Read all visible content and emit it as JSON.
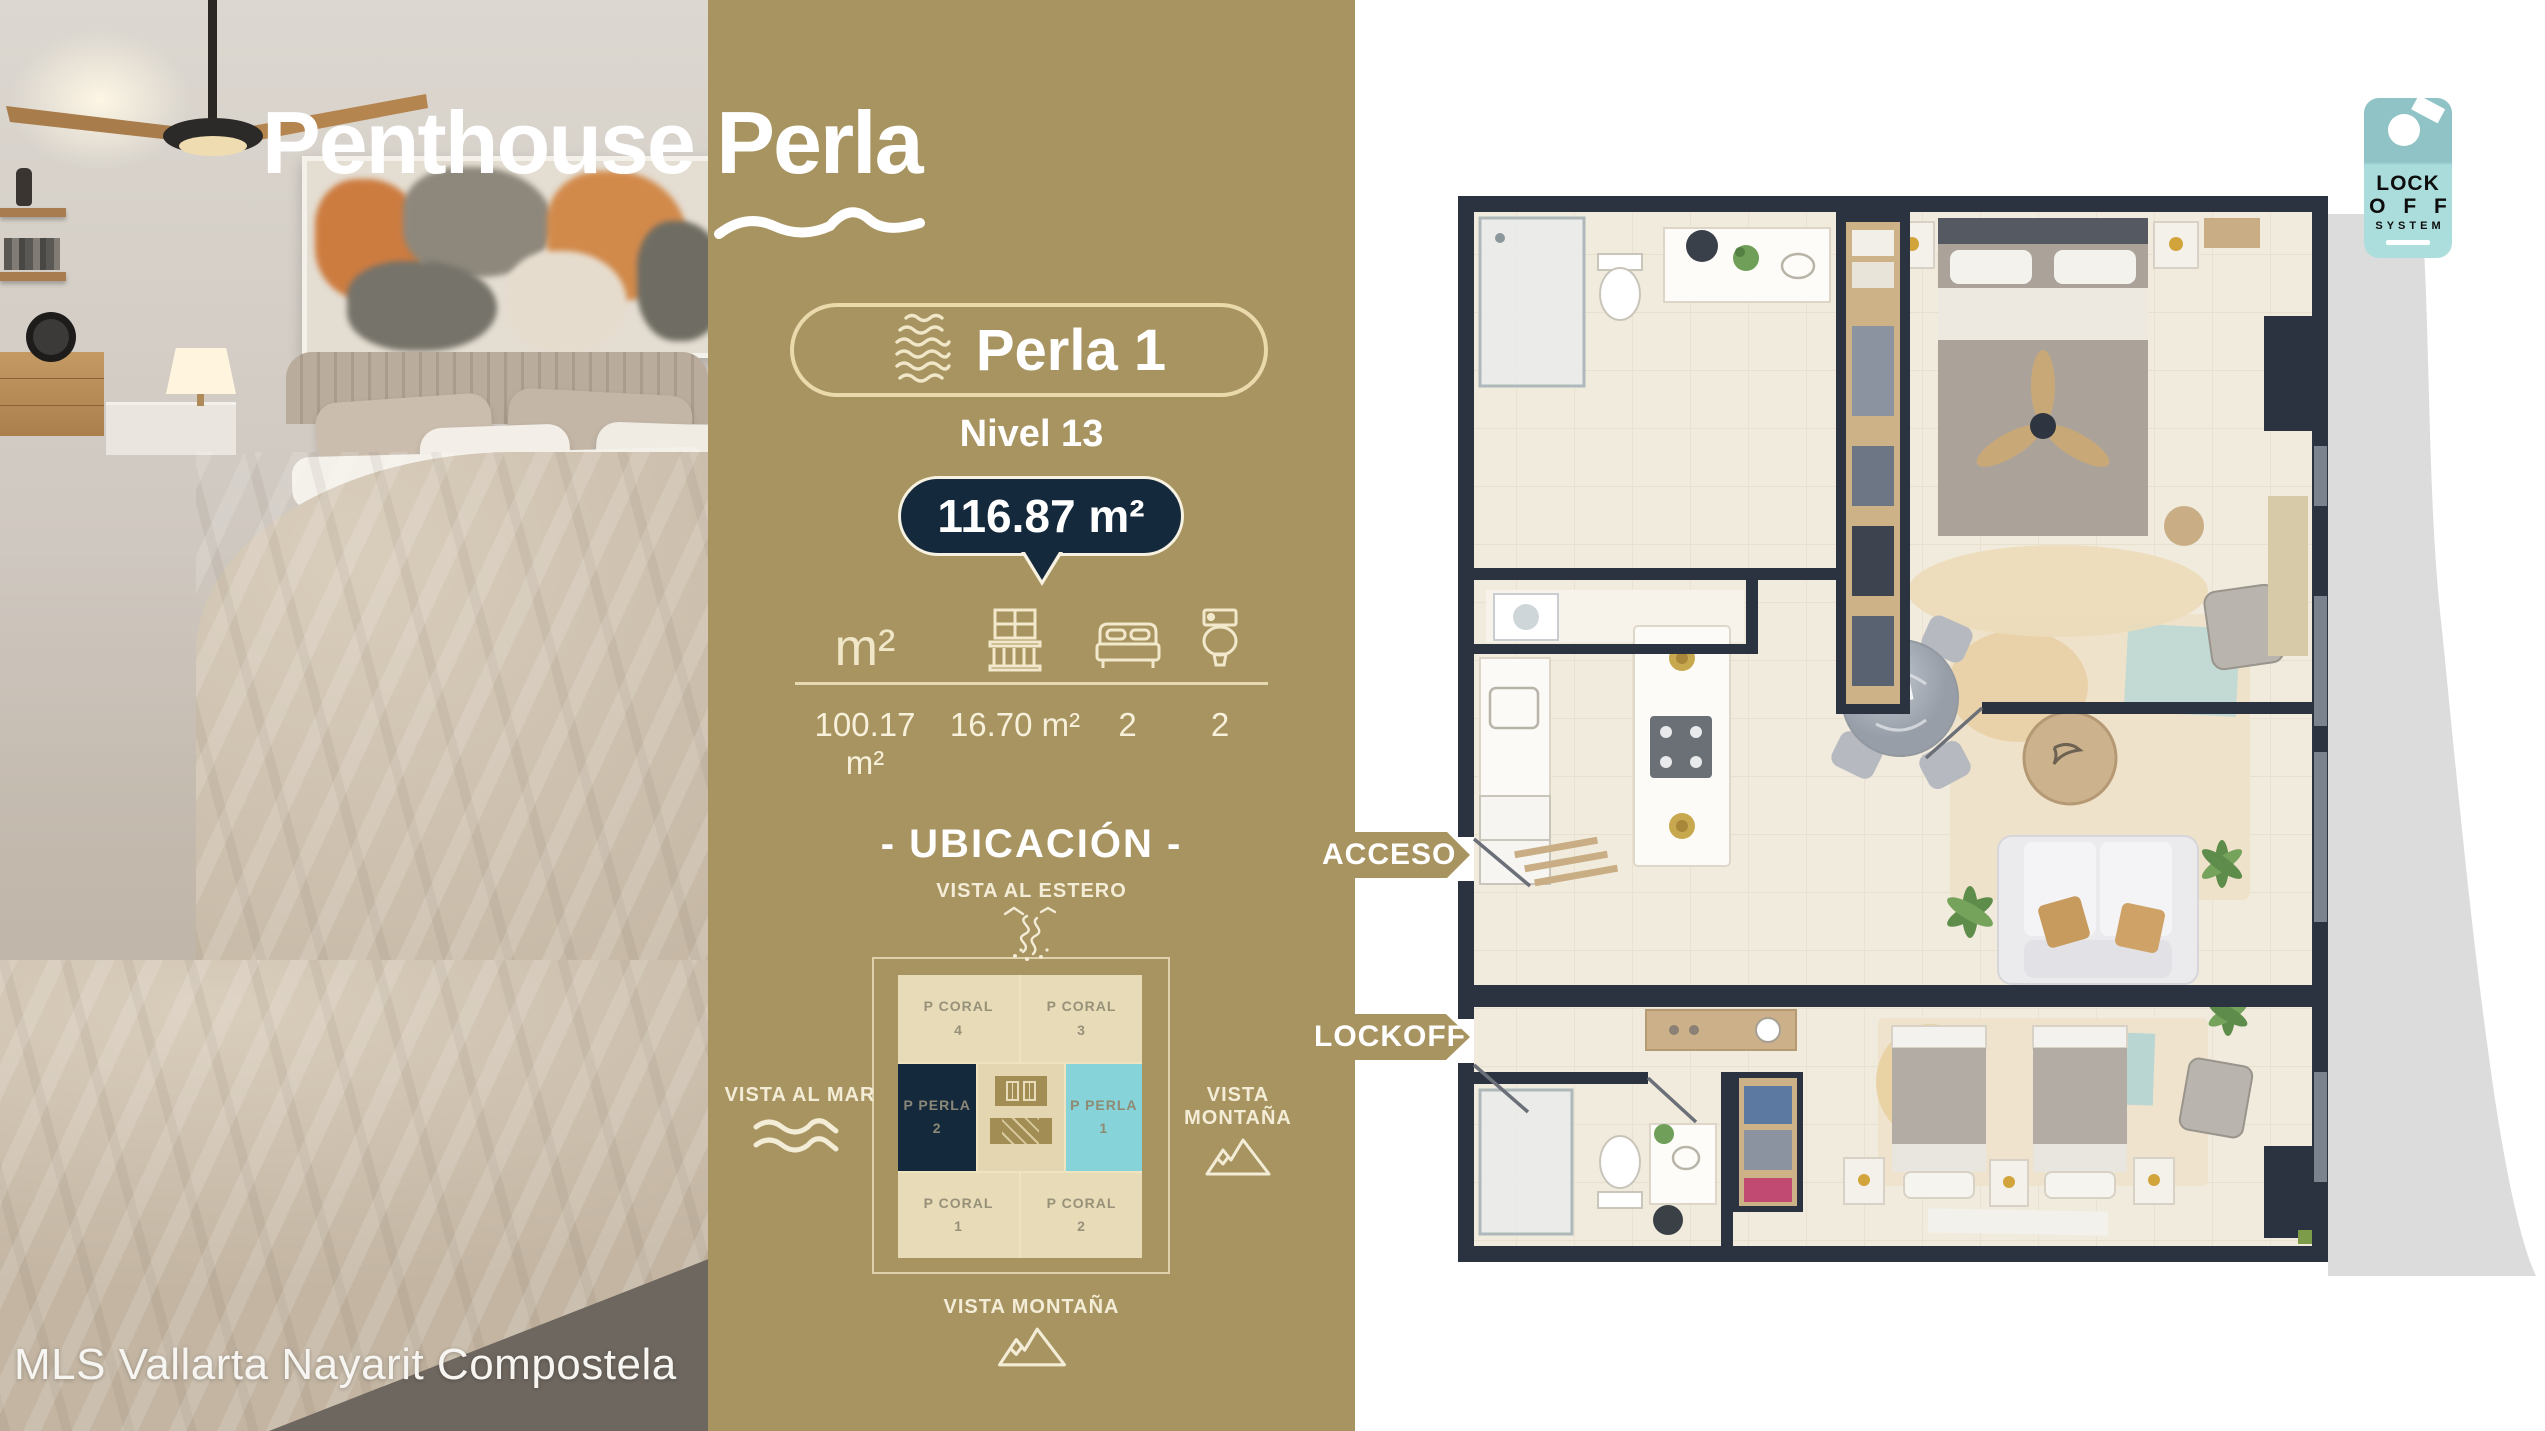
{
  "brand": {
    "title_main": "Penthouse",
    "title_accent": "Perla"
  },
  "watermark": "MLS Vallarta Nayarit Compostela",
  "unit": {
    "name": "Perla 1",
    "level": "Nivel 13",
    "total_area": "116.87 m²"
  },
  "stats": {
    "columns": [
      {
        "icon": "square-meters",
        "label": "m²",
        "value": "100.17 m²"
      },
      {
        "icon": "terrace",
        "value": "16.70 m²"
      },
      {
        "icon": "bed",
        "value": "2"
      },
      {
        "icon": "toilet",
        "value": "2"
      }
    ]
  },
  "location": {
    "heading": "- UBICACIÓN -",
    "views": {
      "top": "VISTA AL ESTERO",
      "left": "VISTA AL MAR",
      "right": "VISTA MONTAÑA",
      "bottom": "VISTA MONTAÑA"
    },
    "grid": {
      "cells": [
        {
          "name": "P CORAL",
          "num": "4"
        },
        {
          "name": "P CORAL",
          "num": "3"
        },
        {
          "name": "P PERLA",
          "num": "2"
        },
        {
          "name": "P PERLA",
          "num": "1"
        },
        {
          "name": "P CORAL",
          "num": "1"
        },
        {
          "name": "P CORAL",
          "num": "2"
        }
      ]
    }
  },
  "callouts": {
    "access": "ACCESO",
    "lockoff": "LOCKOFF"
  },
  "tag": {
    "line1": "LOCK",
    "line2": "O F F",
    "line3": "SYSTEM"
  },
  "colors": {
    "gold": "#a89461",
    "navy": "#14293c",
    "cyan": "#86d3da",
    "cream": "#f0e6c8",
    "beige": "#e8dbb7",
    "wall": "#2b3340",
    "floor": "#f1ebdd",
    "swoosh": "#dcdcdc",
    "teal": "#8fc3c6"
  }
}
